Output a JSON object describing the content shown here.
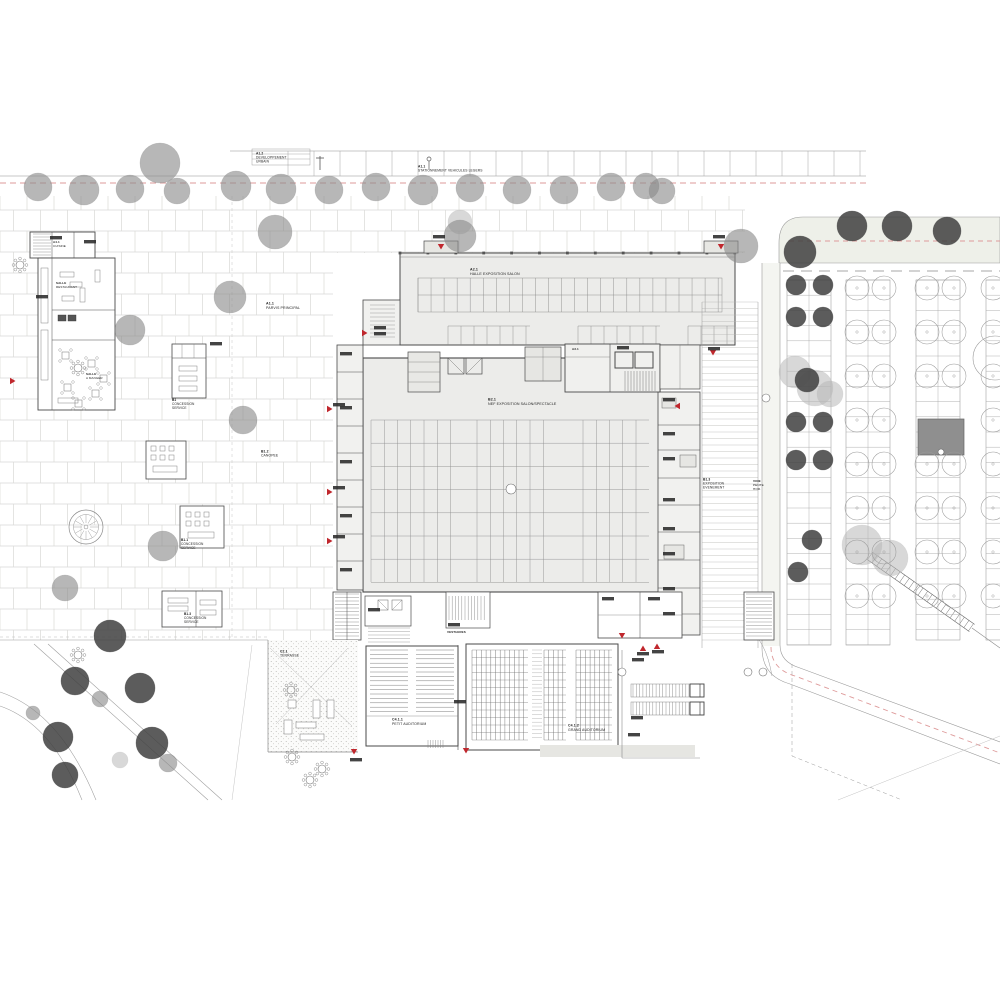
{
  "colors": {
    "accent_red": "#c0272d",
    "pink_dash": "#de9a9a",
    "building_fill": "#ececea",
    "canopy_fill": "#e7e7e3",
    "wall_line": "#4a4a4a",
    "thin_line": "#9a9a9a",
    "paver_line": "#d9d9d6",
    "road_fill": "#eef0e9",
    "tree_dark": "#3f3f3f",
    "tree_mid": "#8a8a8a",
    "tree_light": "#b8b8b8",
    "dark_block": "#8f8f8f"
  },
  "labels": [
    {
      "id": "road-dev-urbain",
      "x": 256,
      "y": 151,
      "size": 3.3,
      "lines": [
        "A1.2",
        "DEVELOPPEMENT",
        "URBAIN"
      ]
    },
    {
      "id": "road-stationnement",
      "x": 418,
      "y": 164,
      "size": 3.3,
      "lines": [
        "A1.1",
        "STATIONNEMENT VEHICULES LEGERS"
      ]
    },
    {
      "id": "parvis-principal",
      "x": 266,
      "y": 301,
      "size": 3.6,
      "lines": [
        "A1.1",
        "PARVIS PRINCIPAL"
      ]
    },
    {
      "id": "halle-exposition",
      "x": 470,
      "y": 267,
      "size": 3.6,
      "lines": [
        "A2.1",
        "HALLE EXPOSITION SALON"
      ]
    },
    {
      "id": "nef-exposition",
      "x": 488,
      "y": 397,
      "size": 3.6,
      "lines": [
        "B2.1",
        "NEF EXPOSITION SALON/SPECTACLE"
      ]
    },
    {
      "id": "concession-a",
      "x": 172,
      "y": 398,
      "size": 3.2,
      "lines": [
        "B1",
        "CONCESSION",
        "SERVICE"
      ]
    },
    {
      "id": "canopee",
      "x": 261,
      "y": 449,
      "size": 3.4,
      "lines": [
        "B1.2",
        "CANOPEE"
      ]
    },
    {
      "id": "concession-b",
      "x": 181,
      "y": 538,
      "size": 3.2,
      "lines": [
        "B1.1",
        "CONCESSION",
        "SERVICE"
      ]
    },
    {
      "id": "concession-c",
      "x": 184,
      "y": 612,
      "size": 3.2,
      "lines": [
        "B1.3",
        "CONCESSION",
        "SERVICE"
      ]
    },
    {
      "id": "exposition-evenement",
      "x": 703,
      "y": 477,
      "size": 3.3,
      "lines": [
        "B1.3",
        "EXPOSITION",
        "EVENEMENT"
      ]
    },
    {
      "id": "voie-pente",
      "x": 753,
      "y": 479,
      "size": 3.1,
      "lines": [
        "VOIE",
        "PENTE",
        "HOR."
      ]
    },
    {
      "id": "petit-auditorium",
      "x": 392,
      "y": 717,
      "size": 3.5,
      "lines": [
        "C4.1.1",
        "PETIT AUDITORIUM"
      ]
    },
    {
      "id": "grand-auditorium",
      "x": 568,
      "y": 723,
      "size": 3.5,
      "lines": [
        "C4.1.2",
        "GRAND AUDITORIUM"
      ]
    },
    {
      "id": "terrasse",
      "x": 280,
      "y": 649,
      "size": 3.4,
      "lines": [
        "C2.1",
        "TERRASSE"
      ]
    },
    {
      "id": "resto-cuisine",
      "x": 53,
      "y": 240,
      "size": 3.0,
      "lines": [
        "A4.1",
        "CUISINE"
      ]
    },
    {
      "id": "resto-salle",
      "x": 56,
      "y": 281,
      "size": 3.0,
      "lines": [
        "SALLE",
        "RESTAURANT"
      ]
    },
    {
      "id": "resto-manger",
      "x": 86,
      "y": 372,
      "size": 3.0,
      "lines": [
        "SALLE",
        "A MANGER"
      ]
    },
    {
      "id": "local-a31",
      "x": 572,
      "y": 347,
      "size": 3.0,
      "lines": [
        "A3.1"
      ]
    },
    {
      "id": "vestiaires",
      "x": 447,
      "y": 630,
      "size": 3.0,
      "lines": [
        "VESTIAIRES"
      ]
    }
  ],
  "trees": {
    "mid": [
      [
        38,
        187,
        14
      ],
      [
        84,
        190,
        15
      ],
      [
        130,
        189,
        14
      ],
      [
        160,
        163,
        20
      ],
      [
        177,
        191,
        13
      ],
      [
        236,
        186,
        15
      ],
      [
        281,
        189,
        15
      ],
      [
        275,
        232,
        17
      ],
      [
        329,
        190,
        14
      ],
      [
        376,
        187,
        14
      ],
      [
        423,
        190,
        15
      ],
      [
        460,
        236,
        16
      ],
      [
        470,
        188,
        14
      ],
      [
        517,
        190,
        14
      ],
      [
        564,
        190,
        14
      ],
      [
        611,
        187,
        14
      ],
      [
        646,
        186,
        13
      ],
      [
        662,
        191,
        13
      ],
      [
        741,
        246,
        17
      ],
      [
        230,
        297,
        16
      ],
      [
        130,
        330,
        15
      ],
      [
        243,
        420,
        14
      ],
      [
        163,
        546,
        15
      ],
      [
        65,
        588,
        13
      ],
      [
        100,
        699,
        8
      ],
      [
        168,
        763,
        9
      ],
      [
        33,
        713,
        7
      ]
    ],
    "dark": [
      [
        800,
        252,
        16
      ],
      [
        852,
        226,
        15
      ],
      [
        897,
        226,
        15
      ],
      [
        947,
        231,
        14
      ],
      [
        796,
        285,
        10
      ],
      [
        823,
        285,
        10
      ],
      [
        796,
        317,
        10
      ],
      [
        823,
        317,
        10
      ],
      [
        796,
        422,
        10
      ],
      [
        823,
        422,
        10
      ],
      [
        796,
        460,
        10
      ],
      [
        823,
        460,
        10
      ],
      [
        812,
        540,
        10
      ],
      [
        798,
        572,
        10
      ],
      [
        110,
        636,
        16
      ],
      [
        75,
        681,
        14
      ],
      [
        140,
        688,
        15
      ],
      [
        58,
        737,
        15
      ],
      [
        152,
        743,
        16
      ],
      [
        65,
        775,
        13
      ],
      [
        807,
        380,
        12
      ]
    ],
    "light": [
      [
        795,
        372,
        16
      ],
      [
        815,
        388,
        18
      ],
      [
        830,
        394,
        13
      ],
      [
        862,
        545,
        20
      ],
      [
        890,
        558,
        18
      ],
      [
        120,
        760,
        8
      ],
      [
        460,
        222,
        12
      ]
    ],
    "outline_cols": [
      [
        857,
        884
      ],
      [
        927,
        954
      ],
      [
        993,
        1020
      ]
    ],
    "outline_rows": [
      288,
      332,
      376,
      420,
      464,
      508,
      552,
      596
    ],
    "outline_r": 12,
    "outline_skip": [
      [
        1,
        3
      ]
    ],
    "outline_big": [
      [
        995,
        358,
        22
      ]
    ]
  },
  "arrows": [
    [
      441,
      248,
      "down"
    ],
    [
      721,
      248,
      "down"
    ],
    [
      331,
      409,
      "right"
    ],
    [
      331,
      492,
      "right"
    ],
    [
      331,
      541,
      "right"
    ],
    [
      366,
      333,
      "right"
    ],
    [
      676,
      406,
      "left"
    ],
    [
      713,
      354,
      "down"
    ],
    [
      643,
      647,
      "up"
    ],
    [
      657,
      645,
      "up"
    ],
    [
      354,
      753,
      "down"
    ],
    [
      466,
      752,
      "down"
    ],
    [
      14,
      381,
      "right"
    ],
    [
      622,
      637,
      "down"
    ]
  ],
  "mini_labels": [
    [
      433,
      235
    ],
    [
      713,
      235
    ],
    [
      340,
      352
    ],
    [
      340,
      406
    ],
    [
      340,
      460
    ],
    [
      340,
      514
    ],
    [
      340,
      568
    ],
    [
      333,
      403
    ],
    [
      333,
      486
    ],
    [
      333,
      535
    ],
    [
      663,
      398
    ],
    [
      663,
      432
    ],
    [
      663,
      457
    ],
    [
      663,
      498
    ],
    [
      663,
      527
    ],
    [
      663,
      552
    ],
    [
      663,
      587
    ],
    [
      663,
      612
    ],
    [
      708,
      347
    ],
    [
      617,
      346
    ],
    [
      368,
      608
    ],
    [
      448,
      623
    ],
    [
      602,
      597
    ],
    [
      648,
      597
    ],
    [
      637,
      652
    ],
    [
      652,
      650
    ],
    [
      350,
      758
    ],
    [
      454,
      700
    ],
    [
      210,
      342
    ],
    [
      632,
      658
    ],
    [
      631,
      716
    ],
    [
      628,
      733
    ],
    [
      374,
      326
    ],
    [
      374,
      332
    ],
    [
      50,
      236
    ],
    [
      84,
      240
    ],
    [
      36,
      295
    ]
  ],
  "circle_markers": [
    [
      622,
      672,
      4
    ],
    [
      748,
      672,
      4
    ],
    [
      763,
      672,
      4
    ],
    [
      766,
      398,
      4
    ],
    [
      511,
      489,
      5
    ],
    [
      941,
      452,
      3
    ]
  ],
  "round_tables": [
    [
      291,
      690
    ],
    [
      292,
      757
    ],
    [
      322,
      769
    ],
    [
      78,
      655
    ],
    [
      20,
      265
    ],
    [
      78,
      368
    ],
    [
      310,
      780
    ]
  ]
}
